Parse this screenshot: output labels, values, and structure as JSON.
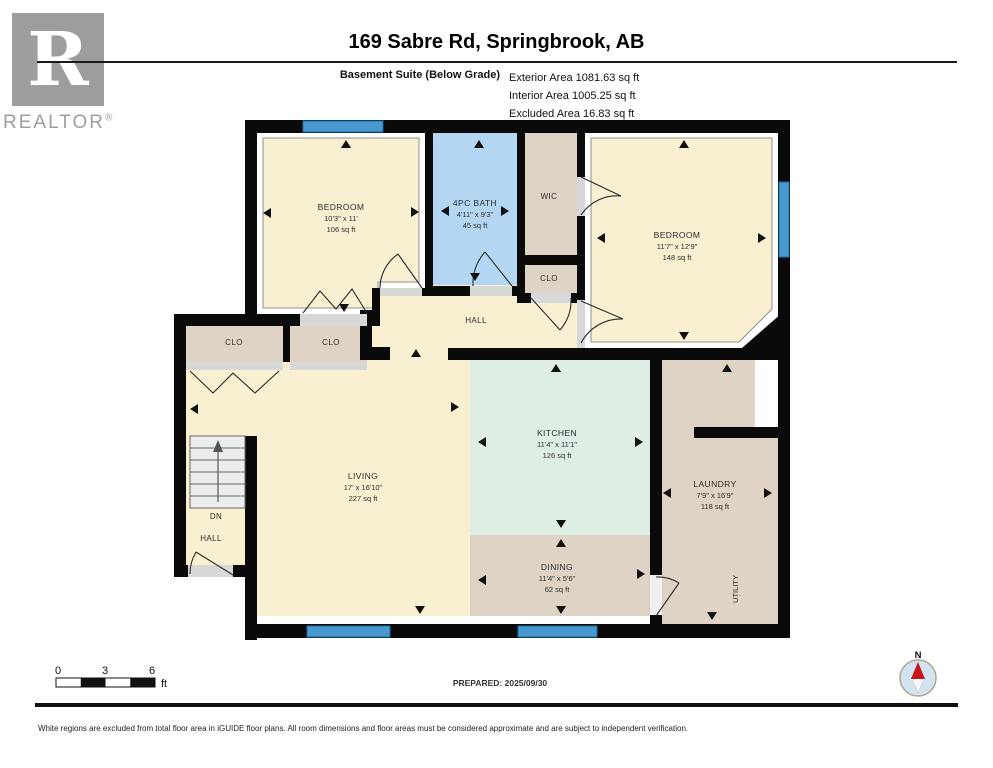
{
  "header": {
    "title": "169 Sabre Rd, Springbrook, AB",
    "floor_label": "Basement Suite (Below Grade)",
    "areas": {
      "exterior": "Exterior Area 1081.63 sq ft",
      "interior": "Interior Area 1005.25 sq ft",
      "excluded": "Excluded Area 16.83 sq ft"
    }
  },
  "logo": {
    "letter": "R",
    "brand": "REALTOR",
    "registered": "®"
  },
  "rooms": {
    "bedroom1": {
      "name": "BEDROOM",
      "dims": "10'3\" x 11'",
      "area": "106 sq ft"
    },
    "bath": {
      "name": "4PC BATH",
      "dims": "4'11\" x 9'3\"",
      "area": "45 sq ft"
    },
    "wic": {
      "name": "WIC"
    },
    "clo_wic": {
      "name": "CLO"
    },
    "bedroom2": {
      "name": "BEDROOM",
      "dims": "11'7\" x 12'9\"",
      "area": "148 sq ft"
    },
    "hall": {
      "name": "HALL"
    },
    "clo1": {
      "name": "CLO"
    },
    "clo2": {
      "name": "CLO"
    },
    "living": {
      "name": "LIVING",
      "dims": "17' x 16'10\"",
      "area": "227 sq ft"
    },
    "kitchen": {
      "name": "KITCHEN",
      "dims": "11'4\" x 11'1\"",
      "area": "126 sq ft"
    },
    "dining": {
      "name": "DINING",
      "dims": "11'4\" x 5'6\"",
      "area": "62 sq ft"
    },
    "laundry": {
      "name": "LAUNDRY",
      "dims": "7'9\" x 16'9\"",
      "area": "118 sq ft"
    },
    "utility": {
      "name": "UTILITY"
    },
    "stairs": {
      "down_label": "DN",
      "hall_label": "HALL"
    }
  },
  "scale_bar": {
    "labels": [
      "0",
      "3",
      "6"
    ],
    "unit": "ft"
  },
  "compass": {
    "north_label": "N"
  },
  "footer": {
    "prepared": "PREPARED: 2025/09/30",
    "disclaimer": "White regions are excluded from total floor area in iGUIDE floor plans. All room dimensions and floor areas must be considered approximate and are subject to independent verification."
  },
  "colors": {
    "wall": "#0a0a0a",
    "floor_cream": "#f9efd1",
    "closet_tan": "#ded3c4",
    "bath_blue": "#b3d7f2",
    "kitchen_mint": "#dfeee5",
    "window_blue": "#4698cf",
    "threshold_grey": "#d8d8d8",
    "compass_red": "#c4161c",
    "logo_grey": "#9d9d9d"
  }
}
